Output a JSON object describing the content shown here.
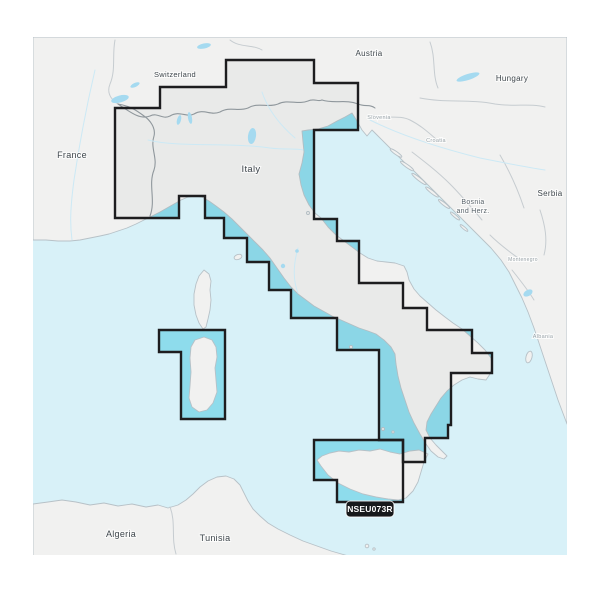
{
  "map": {
    "type": "marine-chart-coverage-map",
    "region_code": "NSEU073R",
    "covered_area": "Italy, Adriatic & Tyrrhenian coasts, Sicily, Sardinia",
    "colors": {
      "background": "#ffffff",
      "sea": "#d8f1f8",
      "land": "#f1f1f0",
      "land_stroke": "#b7c1c7",
      "coverage_water": "#8edcec",
      "coverage_border": "#1d1d1f",
      "lake": "#a5daf0",
      "label": "#3e464c",
      "label_minor": "#99a3a9",
      "label_mid": "#5a646b",
      "badge_bg": "#17191b",
      "badge_text": "#ffffff"
    },
    "labels": {
      "major": [
        {
          "text": "Switzerland",
          "x": 175,
          "y": 77,
          "size": 7.5
        },
        {
          "text": "Austria",
          "x": 369,
          "y": 56,
          "size": 8
        },
        {
          "text": "Hungary",
          "x": 512,
          "y": 81,
          "size": 8
        },
        {
          "text": "France",
          "x": 72,
          "y": 158,
          "size": 9
        },
        {
          "text": "Italy",
          "x": 251,
          "y": 172,
          "size": 9.5
        },
        {
          "text": "Serbia",
          "x": 550,
          "y": 196,
          "size": 8
        },
        {
          "text": "Algeria",
          "x": 121,
          "y": 537,
          "size": 9
        },
        {
          "text": "Tunisia",
          "x": 215,
          "y": 541,
          "size": 9
        }
      ],
      "mid": [
        {
          "text": "Bosnia",
          "x": 473,
          "y": 204,
          "size": 7
        },
        {
          "text": "and Herz.",
          "x": 473,
          "y": 213,
          "size": 7
        }
      ],
      "minor": [
        {
          "text": "Slovenia",
          "x": 379,
          "y": 119,
          "size": 5.5
        },
        {
          "text": "Croatia",
          "x": 436,
          "y": 142,
          "size": 5.5
        },
        {
          "text": "Montenegro",
          "x": 523,
          "y": 261,
          "size": 5
        },
        {
          "text": "Albania",
          "x": 543,
          "y": 338,
          "size": 5.5
        }
      ]
    },
    "badge": {
      "text": "NSEU073R",
      "x": 370,
      "y": 509
    }
  }
}
